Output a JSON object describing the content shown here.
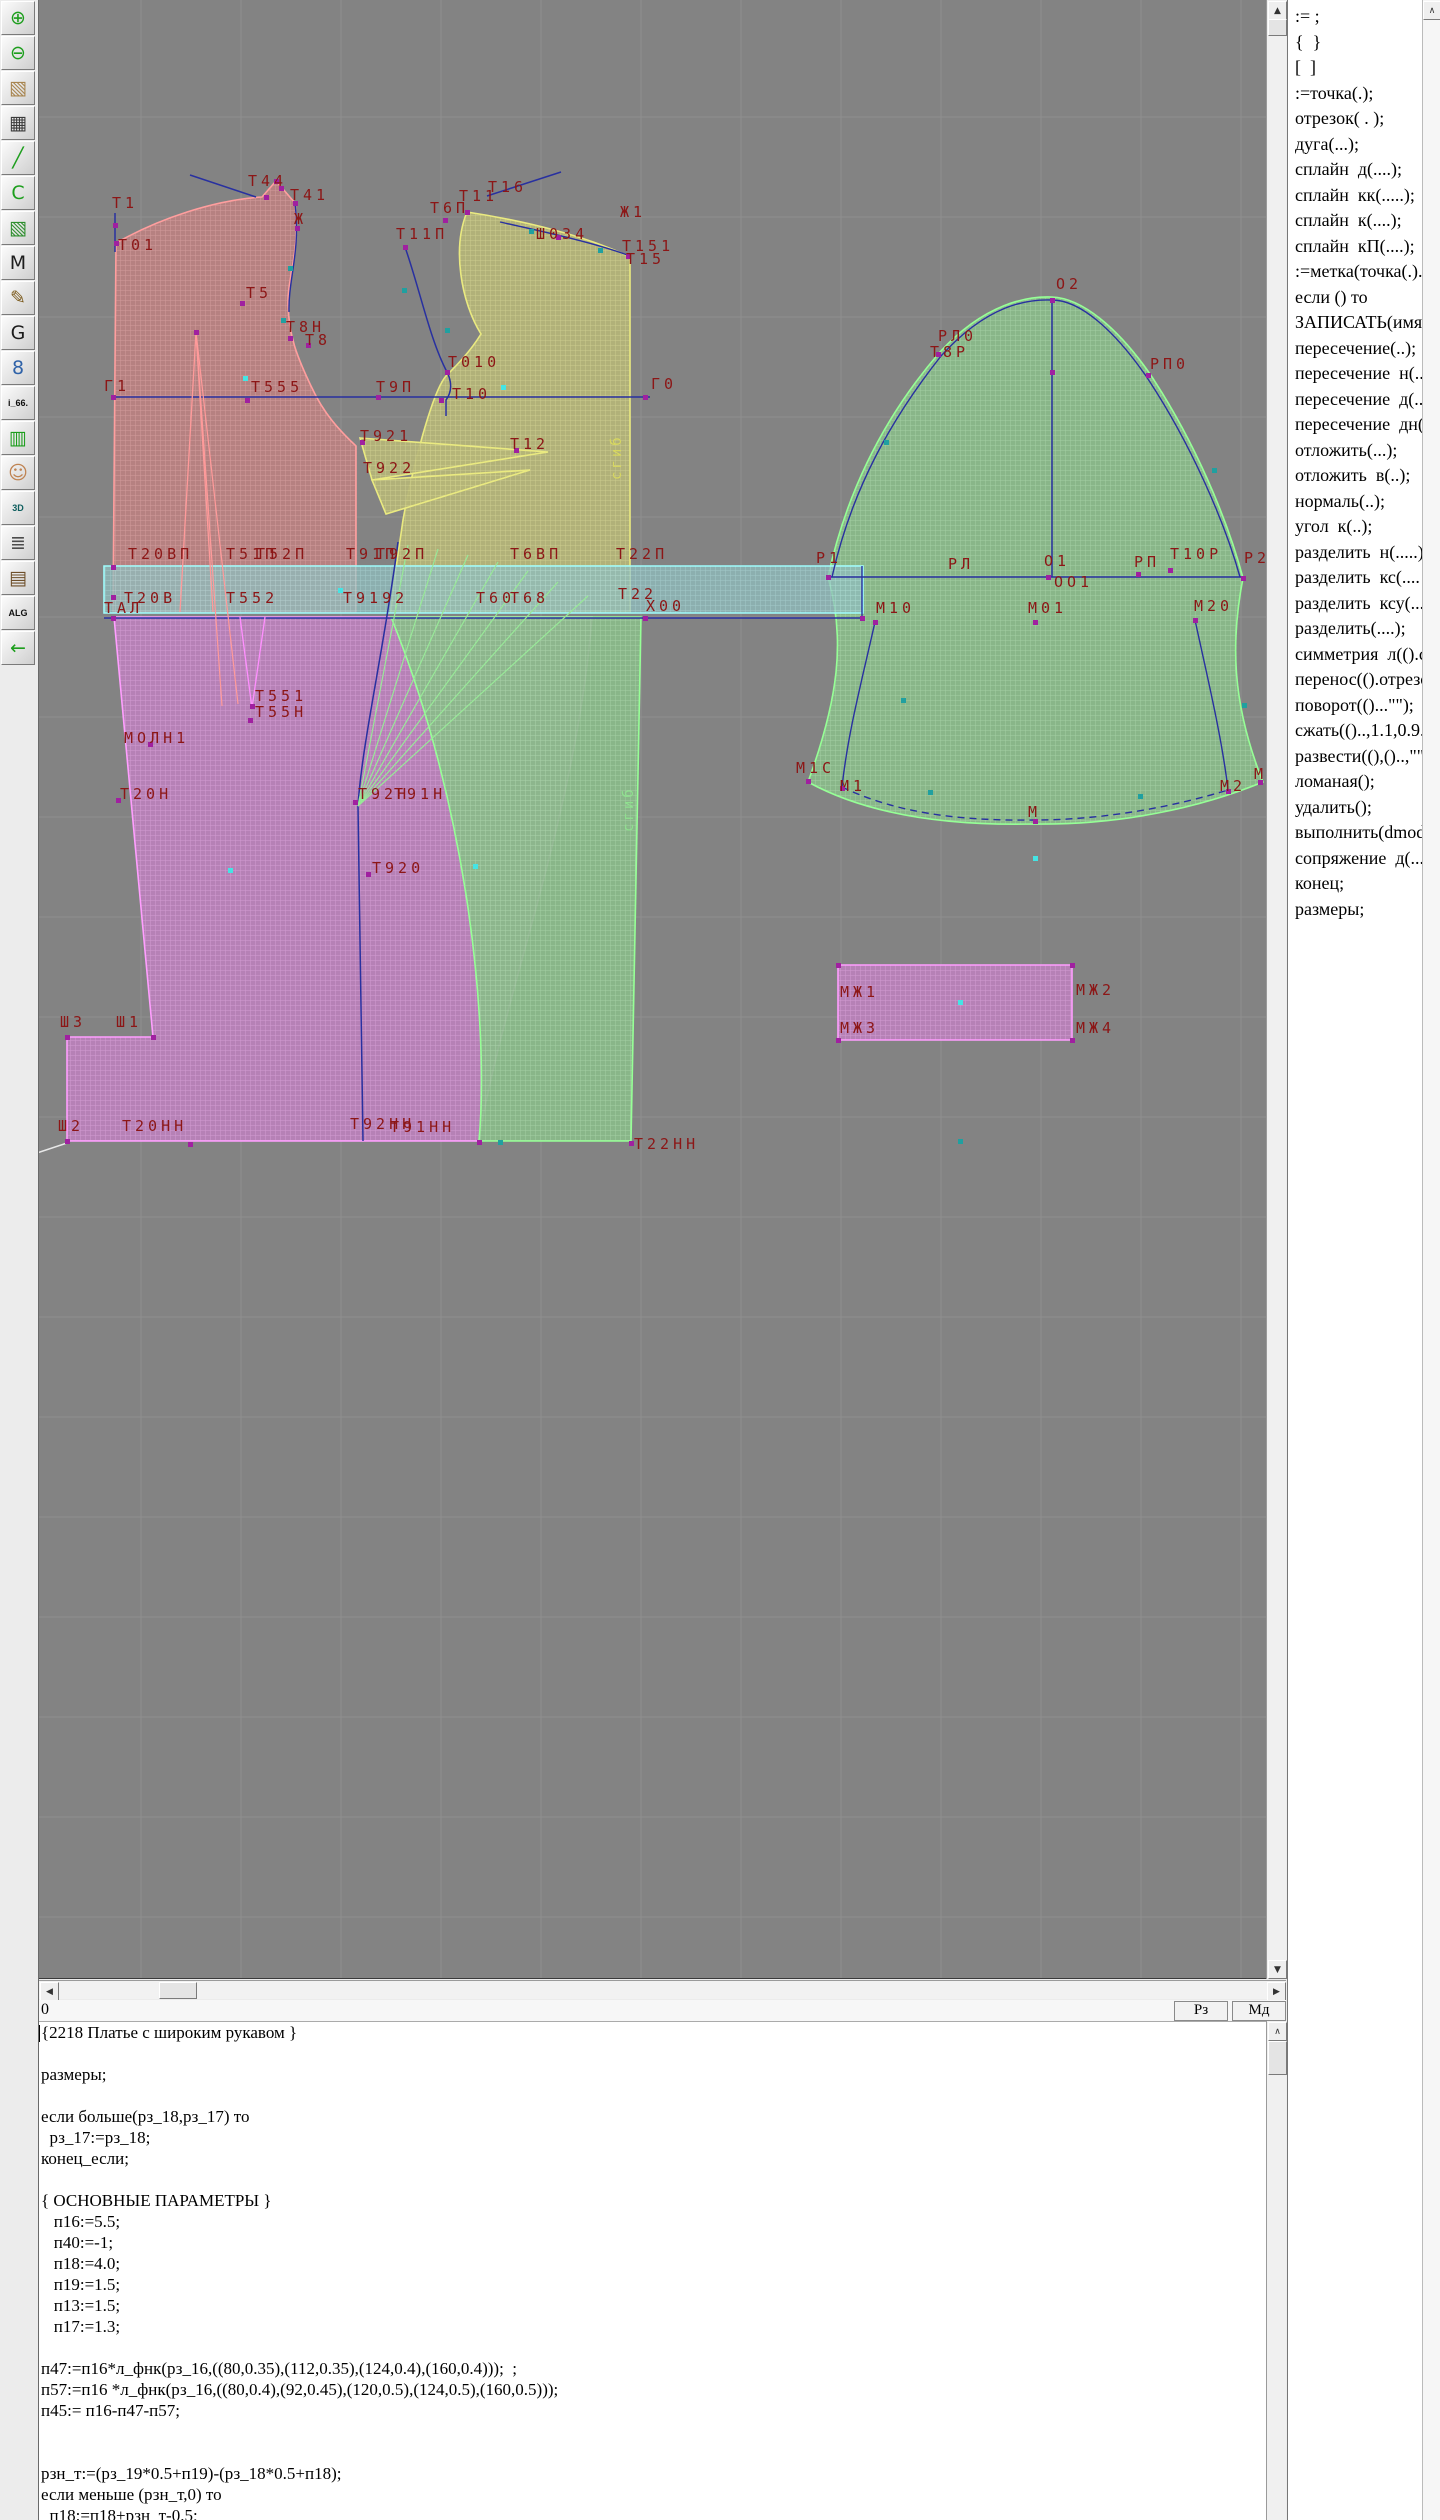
{
  "icons": {
    "up": "▲",
    "down": "▼",
    "left": "◀",
    "right": "▶",
    "panel_up": "∧",
    "editor_up": "∧"
  },
  "toolbar": {
    "items": [
      {
        "name": "zoom-in-button",
        "glyph": "⊕",
        "color": "#1d9e1d"
      },
      {
        "name": "zoom-out-button",
        "glyph": "⊖",
        "color": "#1d9e1d"
      },
      {
        "name": "pattern-sketch-button",
        "glyph": "▧",
        "color": "#a8854f"
      },
      {
        "name": "grid-table-button",
        "glyph": "▦",
        "color": "#3b3b3b"
      },
      {
        "name": "segment-tool-button",
        "glyph": "╱",
        "color": "#1d9e1d"
      },
      {
        "name": "curve-page-button",
        "glyph": "С",
        "color": "#1d9e1d"
      },
      {
        "name": "pattern-piece-button",
        "glyph": "▧",
        "color": "#2f8f2f"
      },
      {
        "name": "m-page-button",
        "glyph": "M",
        "color": "#1c1c1c"
      },
      {
        "name": "drafting-tools-button",
        "glyph": "✎",
        "color": "#7c5b1e"
      },
      {
        "name": "g-page-button",
        "glyph": "G",
        "color": "#1c1c1c"
      },
      {
        "name": "ruler-button",
        "glyph": "8",
        "color": "#2f62a8"
      },
      {
        "name": "i66-button",
        "glyph": "i_66.",
        "color": "#101010",
        "small": true
      },
      {
        "name": "size-table-button",
        "glyph": "▥",
        "color": "#1d9e1d"
      },
      {
        "name": "portrait-button",
        "glyph": "☺",
        "color": "#bf8352"
      },
      {
        "name": "tool-3d-button",
        "glyph": "3D",
        "color": "#0e5e5e",
        "small": true
      },
      {
        "name": "text-list-button",
        "glyph": "≣",
        "color": "#4c4c4c"
      },
      {
        "name": "books-button",
        "glyph": "▤",
        "color": "#6e4f2a"
      },
      {
        "name": "alg-button",
        "glyph": "ALG",
        "color": "#101010",
        "small": true
      },
      {
        "name": "exit-button",
        "glyph": "←",
        "color": "#1d9e1d"
      }
    ]
  },
  "statusbar": {
    "value": "0",
    "buttons": [
      {
        "name": "rz-button",
        "label": "Рз"
      },
      {
        "name": "md-button",
        "label": "Мд"
      }
    ]
  },
  "right_panel": {
    "commands": [
      ":= ;",
      "{  }",
      "[  ]",
      ":=точка(.);",
      "отрезок( . );",
      "дуга(...);",
      "сплайн  д(....);",
      "сплайн  кк(.....);",
      "сплайн  к(....);",
      "сплайн  кП(....);",
      ":=метка(точка(.)..",
      "если () то",
      "ЗАПИСАТЬ(имя=",
      "пересечение(..);",
      "пересечение  н(..",
      "пересечение  д(..",
      "пересечение  дн(",
      "отложить(...);",
      "отложить  в(..);",
      "нормаль(..);",
      "угол  к(..);",
      "разделить  н(.....)",
      "разделить  кс(....",
      "разделить  ксу(...",
      "разделить(....);",
      "симметрия  л(().с",
      "перенос(().отрезо",
      "поворот(()...\"\");",
      "сжать(()..,1.1,0.9.",
      "развести((),()..,\"\"",
      "ломаная();",
      "удалить();",
      "выполнить(dmod",
      "сопряжение  д(...",
      "конец;",
      "размеры;"
    ]
  },
  "code_editor": {
    "lines": [
      "{2218 Платье с широким рукавом }",
      "",
      "размеры;",
      "",
      "если больше(рз_18,рз_17) то",
      "  рз_17:=рз_18;",
      "конец_если;",
      "",
      "{ ОСНОВНЫЕ ПАРАМЕТРЫ }",
      "   п16:=5.5;",
      "   п40:=-1;",
      "   п18:=4.0;",
      "   п19:=1.5;",
      "   п13:=1.5;",
      "   п17:=1.3;",
      "",
      "п47:=п16*л_фнк(рз_16,((80,0.35),(112,0.35),(124,0.4),(160,0.4)));  ;",
      "п57:=п16 *л_фнк(рз_16,((80,0.4),(92,0.45),(120,0.5),(124,0.5),(160,0.5)));",
      "п45:= п16-п47-п57;",
      "",
      "",
      "рзн_т:=(рз_19*0.5+п19)-(рз_18*0.5+п18);",
      "если меньше (рзн_т,0) то",
      "  п18:=п18+рзн_т-0.5;"
    ]
  },
  "canvas": {
    "bg": "#838383",
    "grid_color": "#8f8f8f",
    "label_color": "#8c1616",
    "marker_colors": {
      "m": "#a020a0",
      "c": "#44e4e4",
      "t": "#20a0a0"
    },
    "patterns": [
      {
        "id": "pat-red",
        "bg": "#ba8181",
        "line": "#d89c9c"
      },
      {
        "id": "pat-yellow",
        "bg": "#b5b578",
        "line": "#d2d28e"
      },
      {
        "id": "pat-magenta",
        "bg": "#ba81ba",
        "line": "#d89cd8"
      },
      {
        "id": "pat-green",
        "bg": "#8aba8a",
        "line": "#a6d6a6"
      },
      {
        "id": "pat-cyan",
        "bg": "#8fbcbc",
        "line": "#abdcdc"
      }
    ],
    "pieces": [
      {
        "name": "back-bodice",
        "pattern": "pat-red",
        "stroke": "#ff9e9e",
        "d": "M116,243 C160,218 215,200 262,197 L276,181 L295,203 C301,248 287,278 288,305 C289,335 296,355 312,388 C324,414 340,431 356,446 L356,612 L113,612 Z"
      },
      {
        "name": "front-bodice",
        "pattern": "pat-yellow",
        "stroke": "#eaea80",
        "d": "M467,212 C452,248 461,302 481,334 C470,352 456,366 446,376 C432,392 412,470 403,520 C398,555 393,585 391,612 L630,612 L630,257 C586,236 526,221 467,212 Z"
      },
      {
        "name": "front-dart-wedge",
        "pattern": "pat-yellow",
        "stroke": "#eaea80",
        "d": "M360,438 L548,452 L372,480 Z"
      },
      {
        "name": "front-dart-wedge-2",
        "pattern": "pat-yellow",
        "stroke": "#eaea80",
        "d": "M372,480 L530,470 L386,514 Z"
      },
      {
        "name": "skirt-back",
        "pattern": "pat-magenta",
        "stroke": "#ff9eff",
        "d": "M114,617 L592,617 C576,820 500,1002 479,1141 L67,1141 L67,1037 L153,1037 Z"
      },
      {
        "name": "skirt-front",
        "pattern": "pat-green",
        "stroke": "#96ff96",
        "d": "M391,617 L641,617 L631,1141 L479,1141 C489,1030 470,812 391,617 Z"
      },
      {
        "name": "sleeve",
        "pattern": "pat-green",
        "stroke": "#96ff96",
        "d": "M828,577 C848,485 888,412 940,352 C985,303 1028,296 1052,297 C1082,298 1118,328 1150,374 C1194,440 1227,518 1243,578 C1231,640 1231,702 1263,782 C1200,808 1120,825 1035,824 C950,826 870,816 808,782 C838,700 846,640 828,577 Z"
      },
      {
        "name": "cuff",
        "pattern": "pat-magenta",
        "stroke": "#ff9eff",
        "d": "M838,965 L1072,965 L1072,1040 L838,1040 Z"
      },
      {
        "name": "waistband",
        "pattern": "pat-cyan",
        "stroke": "#9ffcfc",
        "opacity": 0.78,
        "d": "M104,566 L863,566 L863,613 L104,613 Z"
      }
    ],
    "lines": [
      {
        "d": "M190,175 L256,197",
        "c": "#2830a0",
        "w": 1.5
      },
      {
        "d": "M487,196 L561,172",
        "c": "#2830a0",
        "w": 1.5
      },
      {
        "d": "M113,397 L650,397",
        "c": "#2830a0",
        "w": 1.5
      },
      {
        "d": "M405,247 C420,290 430,340 447,372 C452,382 452,392 446,400 L446,416",
        "c": "#2830a0",
        "w": 1.5
      },
      {
        "d": "M104,618 L863,618",
        "c": "#2830a0",
        "w": 1.5
      },
      {
        "d": "M398,542 C384,650 362,742 358,806 L363,1141",
        "c": "#2830a0",
        "w": 1.5
      },
      {
        "d": "M1052,300 L1052,577",
        "c": "#2830a0",
        "w": 1.5
      },
      {
        "d": "M828,577 L1243,577",
        "c": "#2830a0",
        "w": 1.5
      },
      {
        "d": "M832,577 C852,488 892,418 941,356 C988,304 1028,299 1052,300 C1080,300 1114,330 1146,376 C1190,442 1224,520 1240,577",
        "c": "#2830a0",
        "w": 1.4
      },
      {
        "d": "M875,622 C862,680 848,732 842,787",
        "c": "#2830a0",
        "w": 1.4
      },
      {
        "d": "M1195,620 C1208,680 1222,738 1228,790",
        "c": "#2830a0",
        "w": 1.4
      },
      {
        "d": "M842,787 C900,815 968,821 1035,820 C1105,820 1176,806 1228,790",
        "c": "#2830a0",
        "w": 1.4,
        "dash": "7,5"
      },
      {
        "d": "M115,213 L115,252",
        "c": "#2830a0",
        "w": 1.5
      },
      {
        "d": "M500,222 C545,232 596,243 630,256",
        "c": "#2830a0",
        "w": 1.4
      },
      {
        "d": "M295,203 C301,250 288,280 289,312",
        "c": "#2830a0",
        "w": 1.4
      },
      {
        "d": "M862,566 L862,618",
        "c": "#2830a0",
        "w": 1.4
      },
      {
        "d": "M4,1164 L67,1143",
        "c": "#e8e8e8",
        "w": 1.5
      },
      {
        "d": "M180,612 L196,332 L213,612",
        "c": "#ff9a9a",
        "w": 1.3
      },
      {
        "d": "M196,332 L238,704",
        "c": "#ff9a9a",
        "w": 1.2
      },
      {
        "d": "M196,332 L222,706",
        "c": "#ff9a9a",
        "w": 1.2
      },
      {
        "d": "M240,617 L252,708 L265,617",
        "c": "#ff8fff",
        "w": 1.3
      },
      {
        "d": "M358,806 L408,545",
        "c": "#98e898",
        "w": 1.2
      },
      {
        "d": "M358,806 L438,549",
        "c": "#98e898",
        "w": 1.2
      },
      {
        "d": "M358,806 L468,555",
        "c": "#98e898",
        "w": 1.2
      },
      {
        "d": "M358,806 L498,562",
        "c": "#98e898",
        "w": 1.2
      },
      {
        "d": "M358,806 L528,571",
        "c": "#98e898",
        "w": 1.2
      },
      {
        "d": "M358,806 L558,582",
        "c": "#98e898",
        "w": 1.2
      },
      {
        "d": "M358,806 L588,596",
        "c": "#98e898",
        "w": 1.2
      }
    ],
    "markers": [
      [
        115,
        225,
        "m"
      ],
      [
        116,
        243,
        "m"
      ],
      [
        266,
        197,
        "m"
      ],
      [
        281,
        188,
        "m"
      ],
      [
        295,
        203,
        "m"
      ],
      [
        297,
        228,
        "m"
      ],
      [
        242,
        303,
        "m"
      ],
      [
        290,
        338,
        "m"
      ],
      [
        308,
        345,
        "m"
      ],
      [
        113,
        397,
        "m"
      ],
      [
        247,
        400,
        "m"
      ],
      [
        378,
        397,
        "m"
      ],
      [
        405,
        247,
        "m"
      ],
      [
        467,
        212,
        "m"
      ],
      [
        445,
        220,
        "m"
      ],
      [
        558,
        237,
        "m"
      ],
      [
        628,
        256,
        "m"
      ],
      [
        447,
        372,
        "m"
      ],
      [
        441,
        400,
        "m"
      ],
      [
        645,
        397,
        "m"
      ],
      [
        516,
        450,
        "m"
      ],
      [
        362,
        442,
        "m"
      ],
      [
        113,
        567,
        "m"
      ],
      [
        113,
        597,
        "m"
      ],
      [
        113,
        618,
        "m"
      ],
      [
        645,
        618,
        "m"
      ],
      [
        862,
        618,
        "m"
      ],
      [
        150,
        744,
        "m"
      ],
      [
        118,
        800,
        "m"
      ],
      [
        252,
        706,
        "m"
      ],
      [
        250,
        720,
        "m"
      ],
      [
        67,
        1037,
        "m"
      ],
      [
        153,
        1037,
        "m"
      ],
      [
        67,
        1141,
        "m"
      ],
      [
        190,
        1144,
        "m"
      ],
      [
        355,
        802,
        "m"
      ],
      [
        368,
        874,
        "m"
      ],
      [
        479,
        1142,
        "m"
      ],
      [
        631,
        1143,
        "m"
      ],
      [
        828,
        577,
        "m"
      ],
      [
        1052,
        300,
        "m"
      ],
      [
        1243,
        578,
        "m"
      ],
      [
        938,
        354,
        "m"
      ],
      [
        1148,
        375,
        "m"
      ],
      [
        1048,
        577,
        "m"
      ],
      [
        1138,
        574,
        "m"
      ],
      [
        1170,
        570,
        "m"
      ],
      [
        1195,
        620,
        "m"
      ],
      [
        1035,
        622,
        "m"
      ],
      [
        875,
        622,
        "m"
      ],
      [
        808,
        781,
        "m"
      ],
      [
        842,
        788,
        "m"
      ],
      [
        1035,
        821,
        "m"
      ],
      [
        1228,
        791,
        "m"
      ],
      [
        1260,
        782,
        "m"
      ],
      [
        838,
        965,
        "m"
      ],
      [
        1072,
        965,
        "m"
      ],
      [
        838,
        1040,
        "m"
      ],
      [
        1072,
        1040,
        "m"
      ],
      [
        1052,
        372,
        "m"
      ],
      [
        276,
        181,
        "m"
      ],
      [
        196,
        332,
        "m"
      ],
      [
        245,
        378,
        "c"
      ],
      [
        503,
        387,
        "c"
      ],
      [
        340,
        590,
        "c"
      ],
      [
        230,
        870,
        "c"
      ],
      [
        475,
        866,
        "c"
      ],
      [
        1035,
        858,
        "c"
      ],
      [
        960,
        1002,
        "c"
      ],
      [
        404,
        290,
        "t"
      ],
      [
        447,
        330,
        "t"
      ],
      [
        290,
        268,
        "t"
      ],
      [
        283,
        320,
        "t"
      ],
      [
        600,
        250,
        "t"
      ],
      [
        531,
        231,
        "t"
      ],
      [
        886,
        442,
        "t"
      ],
      [
        1214,
        470,
        "t"
      ],
      [
        903,
        700,
        "t"
      ],
      [
        1244,
        705,
        "t"
      ],
      [
        930,
        792,
        "t"
      ],
      [
        1140,
        796,
        "t"
      ],
      [
        960,
        1141,
        "t"
      ],
      [
        500,
        1142,
        "t"
      ]
    ],
    "labels": [
      [
        "Т1",
        112,
        208
      ],
      [
        "Т01",
        118,
        250
      ],
      [
        "Т44",
        248,
        186
      ],
      [
        "Т41",
        290,
        200
      ],
      [
        "Ж",
        294,
        224
      ],
      [
        "Т5",
        246,
        298
      ],
      [
        "Т8Н",
        286,
        332
      ],
      [
        "Т8",
        305,
        345
      ],
      [
        "Г1",
        104,
        391
      ],
      [
        "Т555",
        251,
        392
      ],
      [
        "Т9П",
        376,
        392
      ],
      [
        "Т921",
        360,
        441
      ],
      [
        "Т922",
        363,
        473
      ],
      [
        "Т11П",
        396,
        239
      ],
      [
        "Т6П",
        430,
        213
      ],
      [
        "Т11",
        459,
        201
      ],
      [
        "Т16",
        488,
        192
      ],
      [
        "Ж1",
        620,
        217
      ],
      [
        "Ш034",
        536,
        239
      ],
      [
        "Т151",
        622,
        251
      ],
      [
        "Т15",
        626,
        264
      ],
      [
        "Т010",
        448,
        367
      ],
      [
        "Т10",
        452,
        399
      ],
      [
        "Г0",
        651,
        389
      ],
      [
        "Т12",
        510,
        449
      ],
      [
        "Т20ВП",
        128,
        559
      ],
      [
        "Т51П",
        226,
        559
      ],
      [
        "Т52П",
        256,
        559
      ],
      [
        "Т91П",
        346,
        559
      ],
      [
        "Т92П",
        376,
        559
      ],
      [
        "Т6ВП",
        510,
        559
      ],
      [
        "Т22П",
        616,
        559
      ],
      [
        "Т20В",
        124,
        603
      ],
      [
        "Т552",
        226,
        603
      ],
      [
        "Т9192",
        343,
        603
      ],
      [
        "Т60",
        476,
        603
      ],
      [
        "Т68",
        510,
        603
      ],
      [
        "Т22",
        618,
        599
      ],
      [
        "Х00",
        646,
        611
      ],
      [
        "ТАЛ",
        104,
        613
      ],
      [
        "МОЛН1",
        124,
        743
      ],
      [
        "Т551",
        255,
        701
      ],
      [
        "Т55Н",
        255,
        717
      ],
      [
        "Т20Н",
        120,
        799
      ],
      [
        "Ш3",
        60,
        1027
      ],
      [
        "Ш1",
        116,
        1027
      ],
      [
        "Т920",
        372,
        873
      ],
      [
        "Т92Н",
        358,
        799
      ],
      [
        "Т91Н",
        394,
        799
      ],
      [
        "Ш2",
        58,
        1131
      ],
      [
        "Т20НН",
        122,
        1131
      ],
      [
        "Т92НН",
        350,
        1129
      ],
      [
        "Т91НН",
        390,
        1132
      ],
      [
        "Т22НН",
        634,
        1149
      ],
      [
        "О2",
        1056,
        289
      ],
      [
        "РЛ0",
        938,
        341
      ],
      [
        "Т8Р",
        930,
        357
      ],
      [
        "РП0",
        1150,
        369
      ],
      [
        "РЛ",
        948,
        569
      ],
      [
        "О1",
        1044,
        566
      ],
      [
        "ОО1",
        1054,
        587
      ],
      [
        "РП",
        1134,
        567
      ],
      [
        "Т10Р",
        1170,
        559
      ],
      [
        "Р1",
        816,
        563
      ],
      [
        "Р2",
        1244,
        563
      ],
      [
        "М10",
        876,
        613
      ],
      [
        "М01",
        1028,
        613
      ],
      [
        "М20",
        1194,
        611
      ],
      [
        "М1С",
        796,
        773
      ],
      [
        "М1",
        840,
        791
      ],
      [
        "М",
        1028,
        817
      ],
      [
        "М2",
        1220,
        791
      ],
      [
        "М2Н",
        1254,
        779
      ],
      [
        "МЖ1",
        840,
        997
      ],
      [
        "МЖ2",
        1076,
        995
      ],
      [
        "МЖ3",
        840,
        1033
      ],
      [
        "МЖ4",
        1076,
        1033
      ]
    ],
    "vtexts": [
      [
        "сгиб",
        621,
        480,
        "#d8d860"
      ],
      [
        "сгиб",
        633,
        832,
        "#8fe08f"
      ]
    ]
  }
}
